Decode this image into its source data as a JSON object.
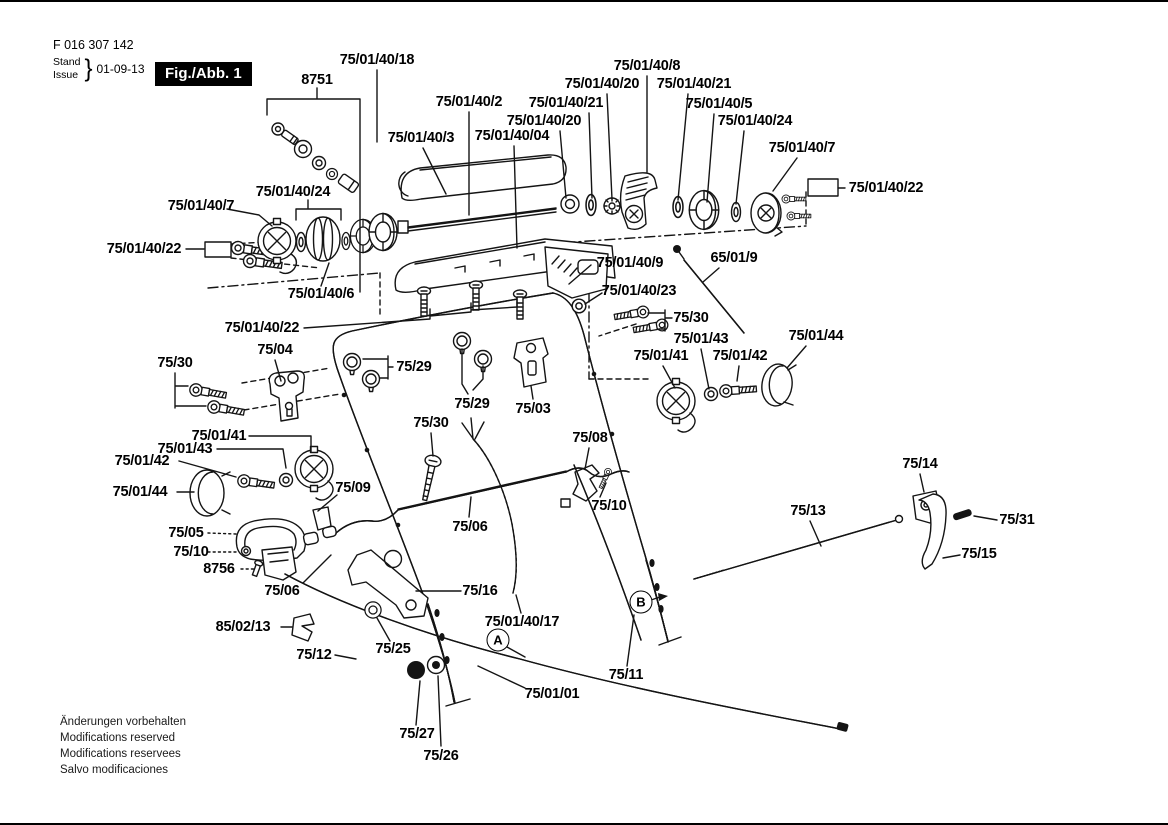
{
  "header": {
    "part_number": "F 016 307 142",
    "stand_label": "Stand",
    "issue_label": "Issue",
    "brace": "}",
    "date": "01-09-13",
    "figure_badge": "Fig./Abb. 1"
  },
  "footer": {
    "lines": [
      "Änderungen vorbehalten",
      "Modifications reserved",
      "Modifications reservees",
      "Salvo modificaciones"
    ]
  },
  "diagram": {
    "labels": [
      {
        "t": "8751",
        "x": 317,
        "y": 78
      },
      {
        "t": "75/01/40/18",
        "x": 377,
        "y": 58
      },
      {
        "t": "75/01/40/2",
        "x": 469,
        "y": 100
      },
      {
        "t": "75/01/40/3",
        "x": 421,
        "y": 136
      },
      {
        "t": "75/01/40/04",
        "x": 512,
        "y": 134
      },
      {
        "t": "75/01/40/20",
        "x": 544,
        "y": 119
      },
      {
        "t": "75/01/40/21",
        "x": 566,
        "y": 101
      },
      {
        "t": "75/01/40/20",
        "x": 602,
        "y": 82
      },
      {
        "t": "75/01/40/8",
        "x": 647,
        "y": 64
      },
      {
        "t": "75/01/40/21",
        "x": 694,
        "y": 82
      },
      {
        "t": "75/01/40/5",
        "x": 719,
        "y": 102
      },
      {
        "t": "75/01/40/24",
        "x": 755,
        "y": 119
      },
      {
        "t": "75/01/40/7",
        "x": 802,
        "y": 146
      },
      {
        "t": "75/01/40/22",
        "x": 886,
        "y": 186
      },
      {
        "t": "75/01/40/24",
        "x": 293,
        "y": 190
      },
      {
        "t": "75/01/40/7",
        "x": 201,
        "y": 204
      },
      {
        "t": "75/01/40/22",
        "x": 144,
        "y": 247
      },
      {
        "t": "75/01/40/6",
        "x": 321,
        "y": 292
      },
      {
        "t": "75/01/40/9",
        "x": 630,
        "y": 261
      },
      {
        "t": "65/01/9",
        "x": 734,
        "y": 256
      },
      {
        "t": "75/01/40/23",
        "x": 639,
        "y": 289
      },
      {
        "t": "75/30",
        "x": 691,
        "y": 316
      },
      {
        "t": "75/01/43",
        "x": 701,
        "y": 337
      },
      {
        "t": "75/01/41",
        "x": 661,
        "y": 354
      },
      {
        "t": "75/01/42",
        "x": 740,
        "y": 354
      },
      {
        "t": "75/01/44",
        "x": 816,
        "y": 334
      },
      {
        "t": "75/01/40/22",
        "x": 262,
        "y": 326
      },
      {
        "t": "75/04",
        "x": 275,
        "y": 348
      },
      {
        "t": "75/30",
        "x": 175,
        "y": 361
      },
      {
        "t": "75/29",
        "x": 414,
        "y": 365
      },
      {
        "t": "75/29",
        "x": 472,
        "y": 402
      },
      {
        "t": "75/03",
        "x": 533,
        "y": 407
      },
      {
        "t": "75/30",
        "x": 431,
        "y": 421
      },
      {
        "t": "75/08",
        "x": 590,
        "y": 436
      },
      {
        "t": "75/10",
        "x": 609,
        "y": 504
      },
      {
        "t": "75/01/41",
        "x": 219,
        "y": 434
      },
      {
        "t": "75/01/43",
        "x": 185,
        "y": 447
      },
      {
        "t": "75/01/42",
        "x": 142,
        "y": 459
      },
      {
        "t": "75/01/44",
        "x": 140,
        "y": 490
      },
      {
        "t": "75/09",
        "x": 353,
        "y": 486
      },
      {
        "t": "75/05",
        "x": 186,
        "y": 531
      },
      {
        "t": "75/10",
        "x": 191,
        "y": 550
      },
      {
        "t": "8756",
        "x": 219,
        "y": 567
      },
      {
        "t": "75/06",
        "x": 282,
        "y": 589
      },
      {
        "t": "75/06",
        "x": 470,
        "y": 525
      },
      {
        "t": "75/16",
        "x": 480,
        "y": 589
      },
      {
        "t": "75/01/40/17",
        "x": 522,
        "y": 620
      },
      {
        "t": "85/02/13",
        "x": 243,
        "y": 625
      },
      {
        "t": "75/12",
        "x": 314,
        "y": 653
      },
      {
        "t": "75/25",
        "x": 393,
        "y": 647
      },
      {
        "t": "75/01/01",
        "x": 552,
        "y": 692
      },
      {
        "t": "75/27",
        "x": 417,
        "y": 732
      },
      {
        "t": "75/26",
        "x": 441,
        "y": 754
      },
      {
        "t": "75/11",
        "x": 626,
        "y": 673
      },
      {
        "t": "75/13",
        "x": 808,
        "y": 509
      },
      {
        "t": "75/14",
        "x": 920,
        "y": 462
      },
      {
        "t": "75/31",
        "x": 1017,
        "y": 518
      },
      {
        "t": "75/15",
        "x": 979,
        "y": 552
      }
    ],
    "markers": [
      {
        "t": "A",
        "x": 498,
        "y": 638
      },
      {
        "t": "B",
        "x": 641,
        "y": 600
      }
    ]
  }
}
